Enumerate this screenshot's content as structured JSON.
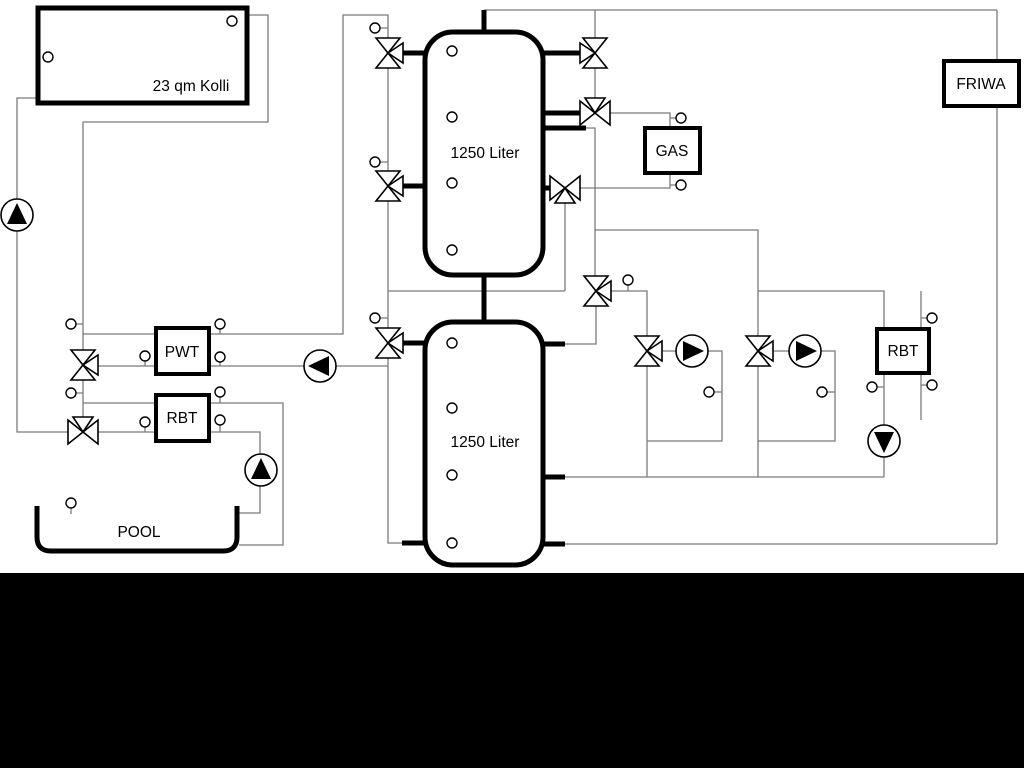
{
  "diagram": {
    "labels": {
      "collector": "23 qm Kolli",
      "tank_top": "1250 Liter",
      "tank_bottom": "1250 Liter",
      "gas": "GAS",
      "pwt": "PWT",
      "rbt_left": "RBT",
      "rbt_right": "RBT",
      "friwa": "FRIWA",
      "pool": "POOL"
    },
    "colors": {
      "background": "#ffffff",
      "letterbox": "#000000",
      "pipe": "#7b7b7b",
      "component_outline": "#000000",
      "component_fill": "#ffffff"
    },
    "icons": {
      "pump": "circle-with-filled-triangle",
      "three_way_valve": "three-triangle-mixing-valve",
      "sensor": "small-circle-with-stem"
    }
  }
}
